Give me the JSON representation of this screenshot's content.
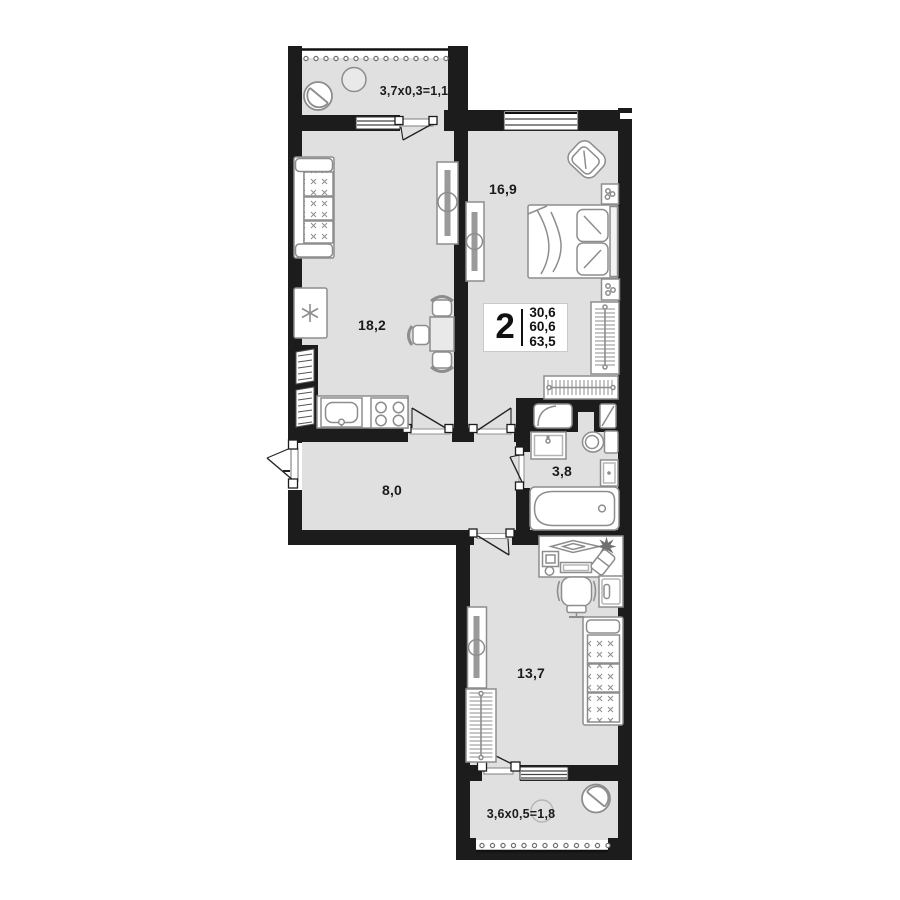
{
  "plan": {
    "title": "2-room apartment floor plan",
    "info_plate": {
      "rooms_count": "2",
      "living_area": "30,6",
      "usable_area": "60,6",
      "total_area": "63,5"
    },
    "room_labels": {
      "balcony_top": "3,7x0,3=1,1",
      "bedroom": "16,9",
      "kitchen_living": "18,2",
      "hallway": "8,0",
      "bathroom": "3,8",
      "bedroom_2": "13,7",
      "balcony_bottom": "3,6x0,5=1,8"
    },
    "colors": {
      "wall": "#1c1c1c",
      "floor": "#e0e0e0",
      "furniture_line": "#8d8d8d",
      "label_text": "#1b1b1b"
    }
  }
}
